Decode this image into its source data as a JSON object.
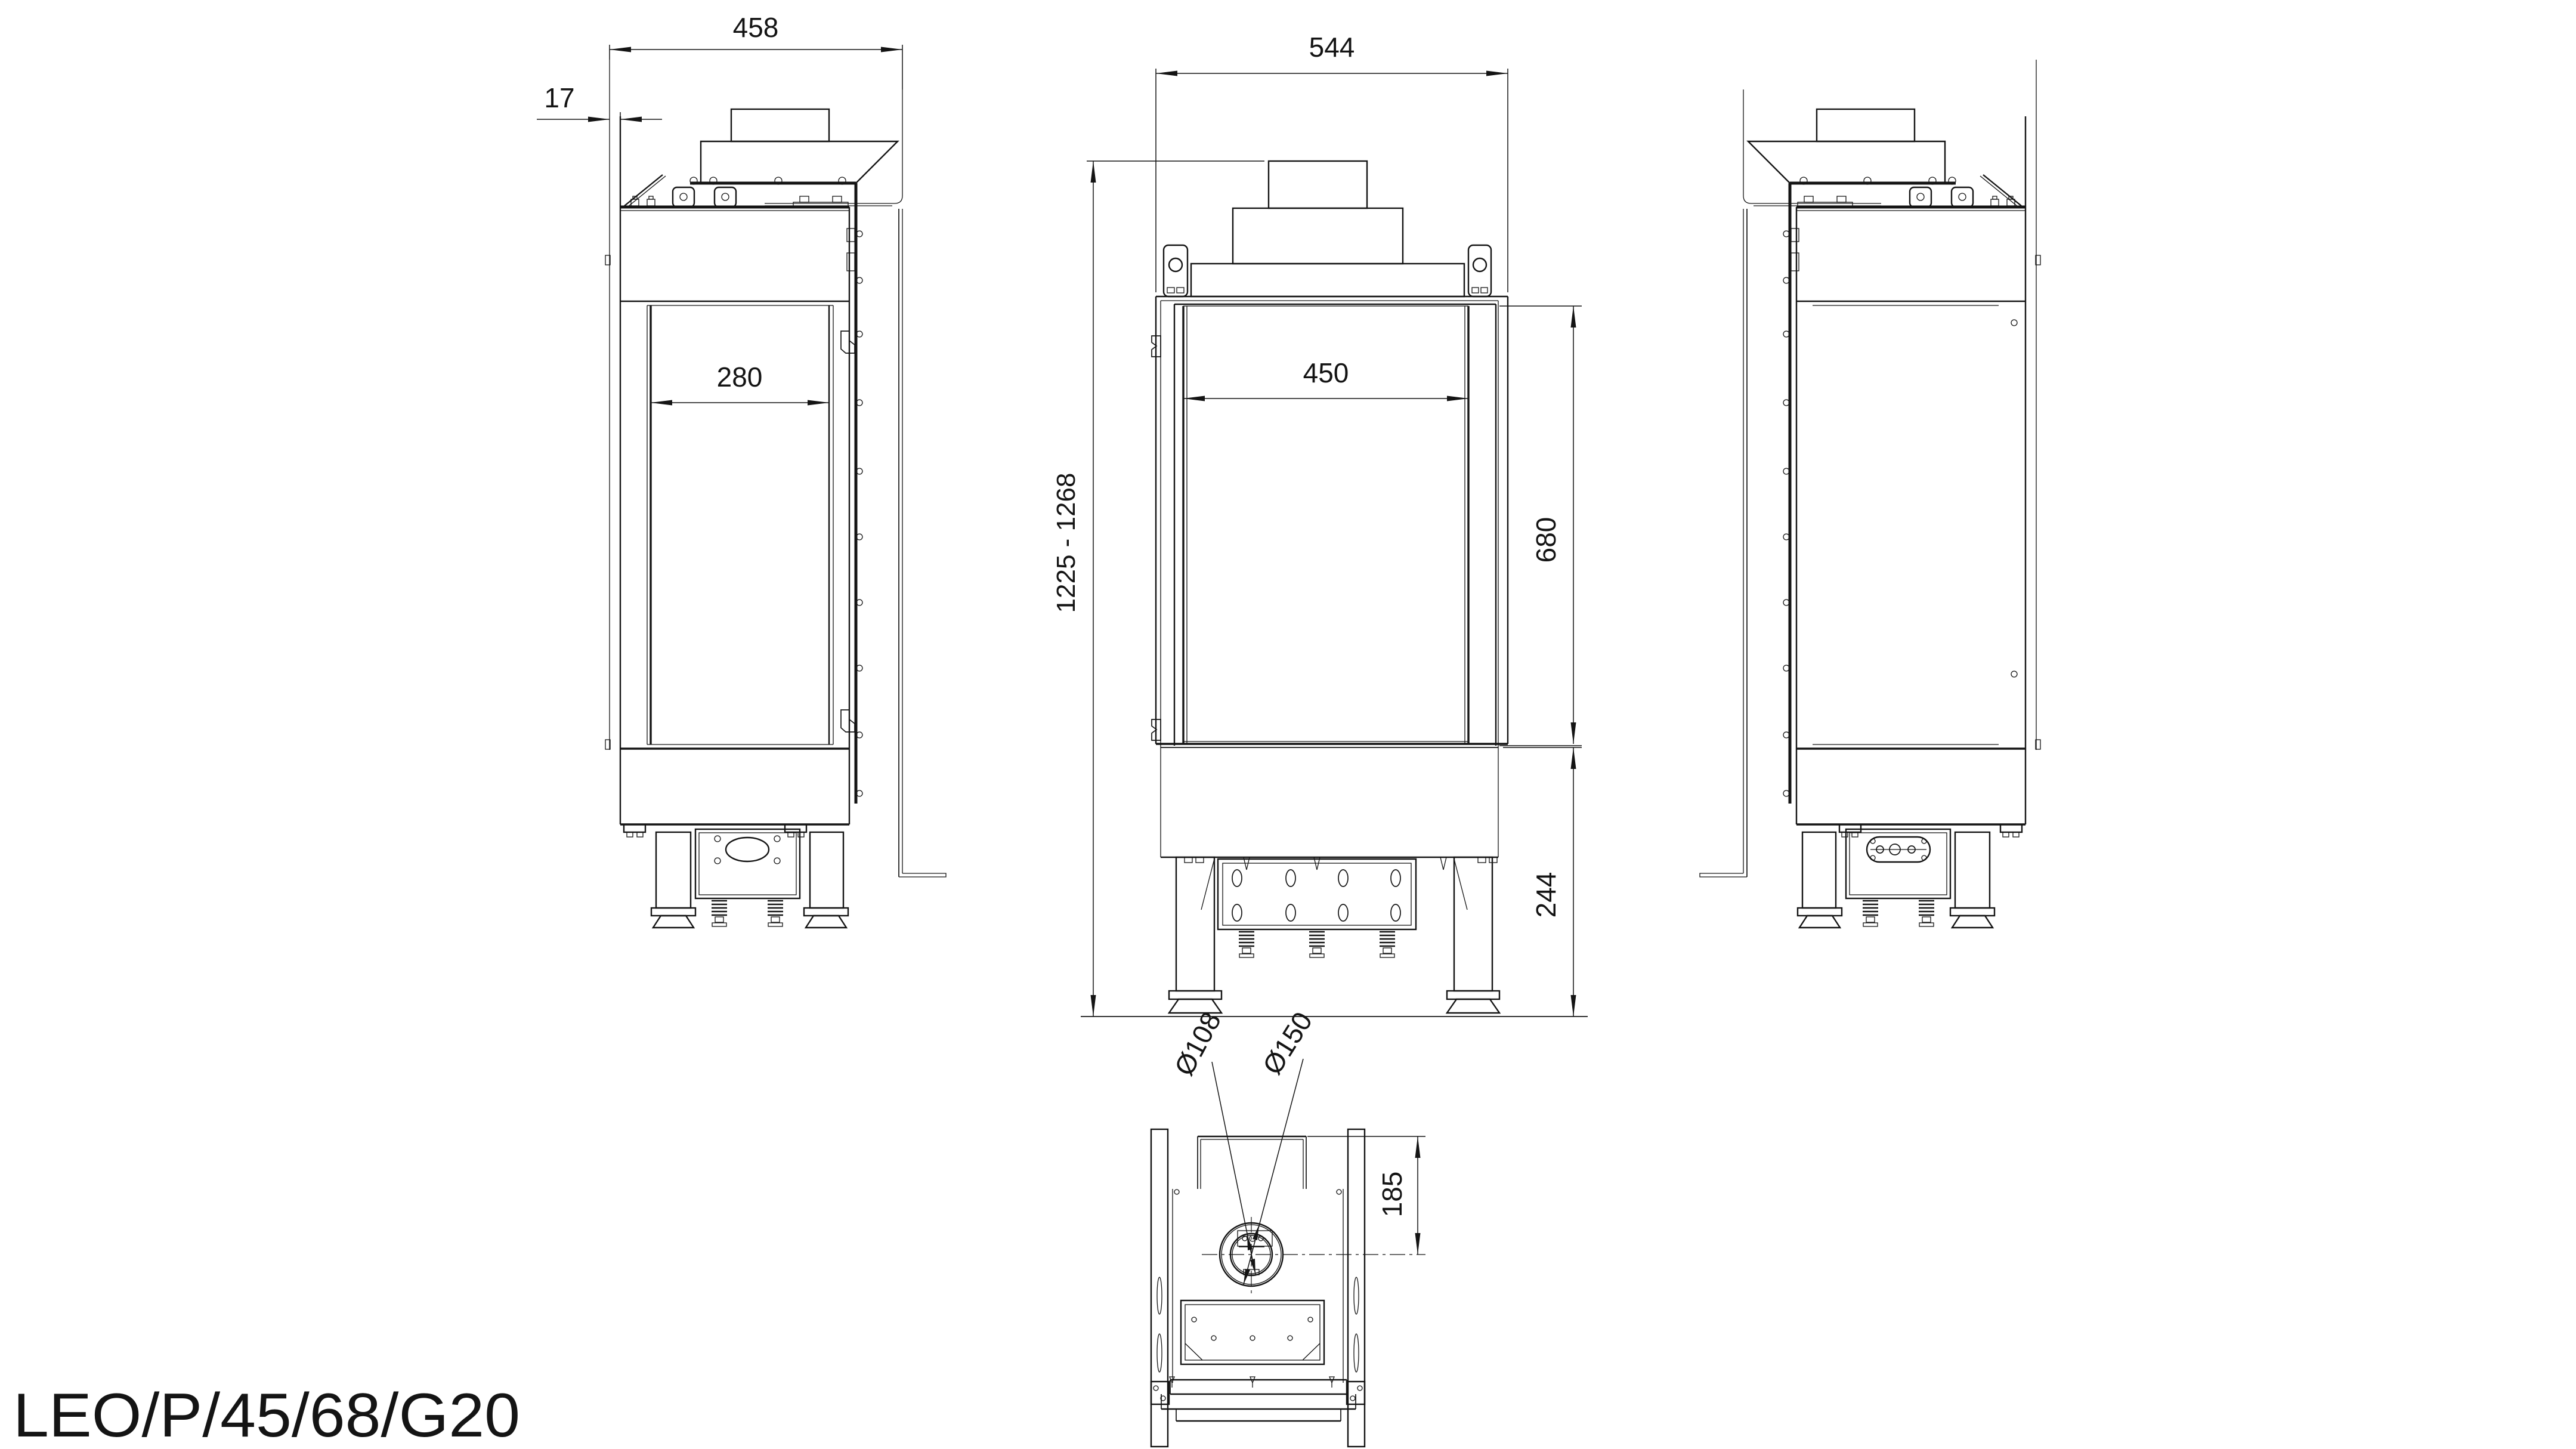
{
  "title_block": {
    "model": "LEO/P/45/68/G20"
  },
  "colors": {
    "background": "#ffffff",
    "line": "#141414"
  },
  "views": {
    "side_left": {
      "label": "left-side-view",
      "dimensions": {
        "overall_depth": "458",
        "front_lip_offset": "17",
        "side_glass_depth": "280"
      }
    },
    "front": {
      "label": "front-view",
      "dimensions": {
        "overall_width": "544",
        "overall_height_range": "1225 - 1268",
        "glass_width": "450",
        "glass_height": "680",
        "base_height": "244"
      }
    },
    "side_right": {
      "label": "right-side-view",
      "dimensions": {}
    },
    "bottom": {
      "label": "plan-view",
      "dimensions": {
        "flue_inner_diameter": "Ø108",
        "flue_outer_diameter": "Ø150",
        "flue_axis_offset": "185"
      }
    }
  }
}
